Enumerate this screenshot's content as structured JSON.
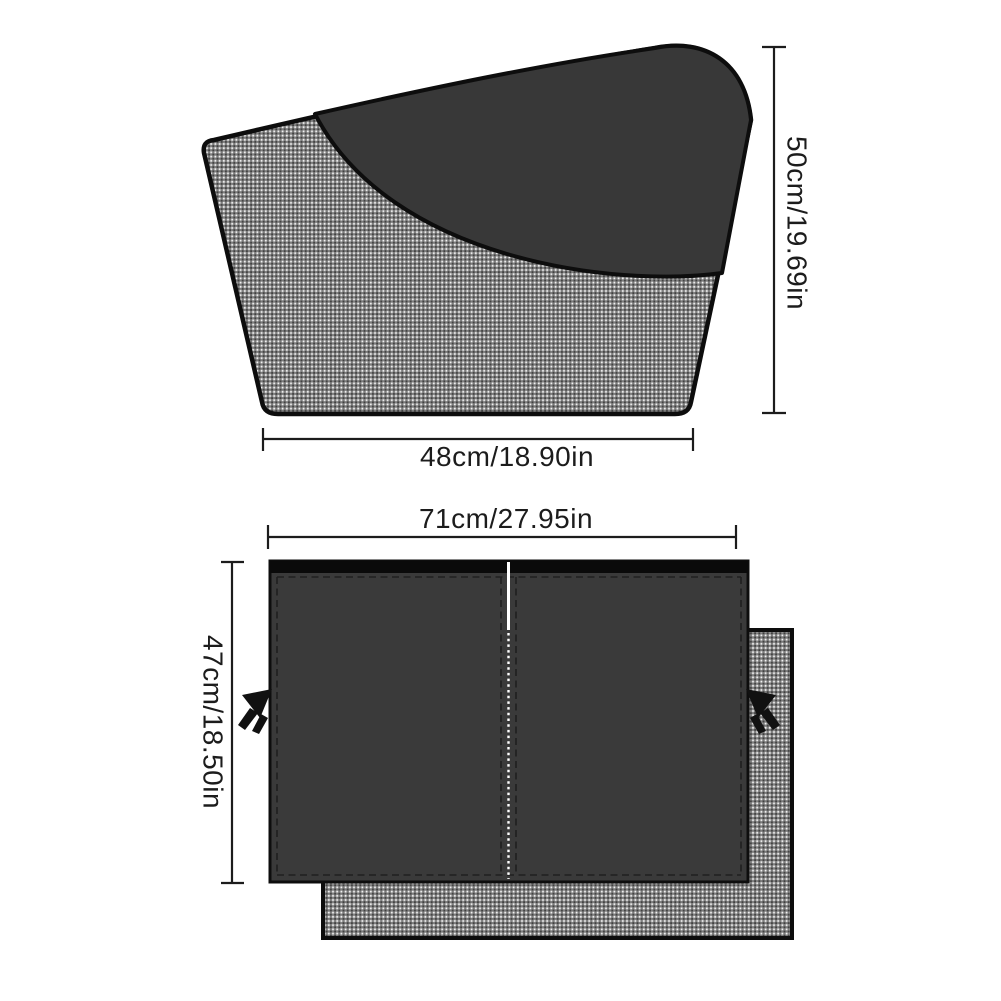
{
  "colors": {
    "background": "#ffffff",
    "line": "#1c1c1c",
    "outline": "#0d0d0d",
    "sunshade_dark": "#383838",
    "curtain_dark": "#3a3a3a",
    "top_bar": "#0a0a0a",
    "mesh_base": "#7d7d7d",
    "mesh_light": "#f2f2f2",
    "mesh_dark": "#414141",
    "stitch_dark": "#1f1f1f",
    "stitch_white": "#ffffff",
    "tassel": "#111111"
  },
  "figures": {
    "sunshade": {
      "width_label": "48cm/18.90in",
      "height_label": "50cm/19.69in"
    },
    "curtain": {
      "width_label": "71cm/27.95in",
      "height_label": "47cm/18.50in"
    }
  }
}
